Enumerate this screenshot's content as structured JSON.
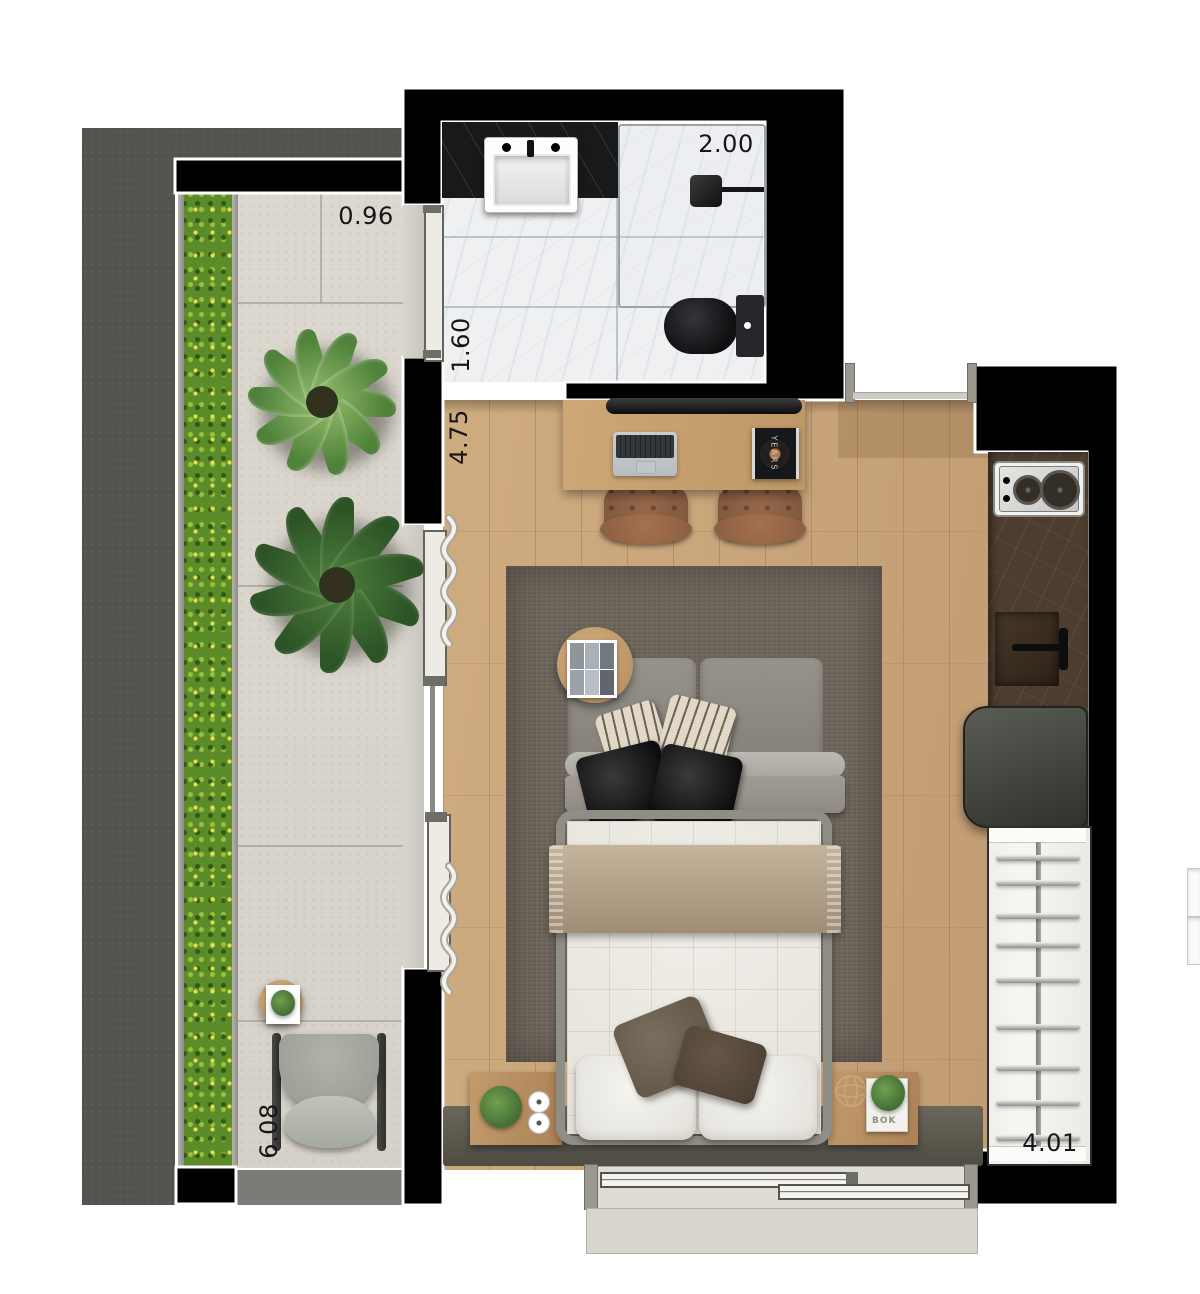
{
  "title": "Studio apartment floor plan",
  "palette": {
    "exterior_slab": "#54524d",
    "wall_fill": "#000000",
    "wall_outline": "#ffffff",
    "balcony_floor": "#d9d5cd",
    "hedge_green": "#5c8c2a",
    "wood_floor": "#c8a377",
    "rug": "#6f665c",
    "bathroom_floor": "#eef0f2",
    "vanity_marble": "#17191b",
    "kitchen_counter": "#4d3d2f",
    "closet_white": "#f4f3f0",
    "sofa_gray": "#8d8982",
    "mattress": "#edebe5",
    "blanket": "#b9a78f"
  },
  "labels": {
    "balcony_width": "0.96",
    "bathroom_width": "2.00",
    "bathroom_depth": "1.60",
    "room_depth": "4.75",
    "balcony_length": "6.08",
    "room_width": "4.01"
  },
  "decor": {
    "record_text": "YEARS",
    "book_text": "BOK"
  },
  "rooms": [
    {
      "name": "balcony",
      "dimensions": [
        "6.08",
        "0.96"
      ],
      "features": [
        "vertical garden hedge",
        "stone tile floor",
        "two large plants",
        "round side table with plant",
        "lounge chair"
      ]
    },
    {
      "name": "bathroom",
      "dimensions": [
        "2.00",
        "1.60"
      ],
      "features": [
        "black marble vanity with sink",
        "glass shower enclosure with rain head",
        "black toilet",
        "white marble floor"
      ]
    },
    {
      "name": "living-sleeping room",
      "dimensions": [
        "4.75"
      ],
      "features": [
        "desk with laptop and framed vinyl record",
        "two leather desk chairs",
        "gray sofa with striped and black pillows",
        "round side table with photo frame",
        "area rug",
        "double bed with throw blanket",
        "two nightstands with plants and candles",
        "headboard bench",
        "sliding glass doors with curtains"
      ]
    },
    {
      "name": "kitchen",
      "dimensions": [
        "4.01"
      ],
      "features": [
        "two-burner cooktop",
        "counter sink with faucet",
        "refrigerator",
        "open wardrobe with rails"
      ]
    }
  ]
}
